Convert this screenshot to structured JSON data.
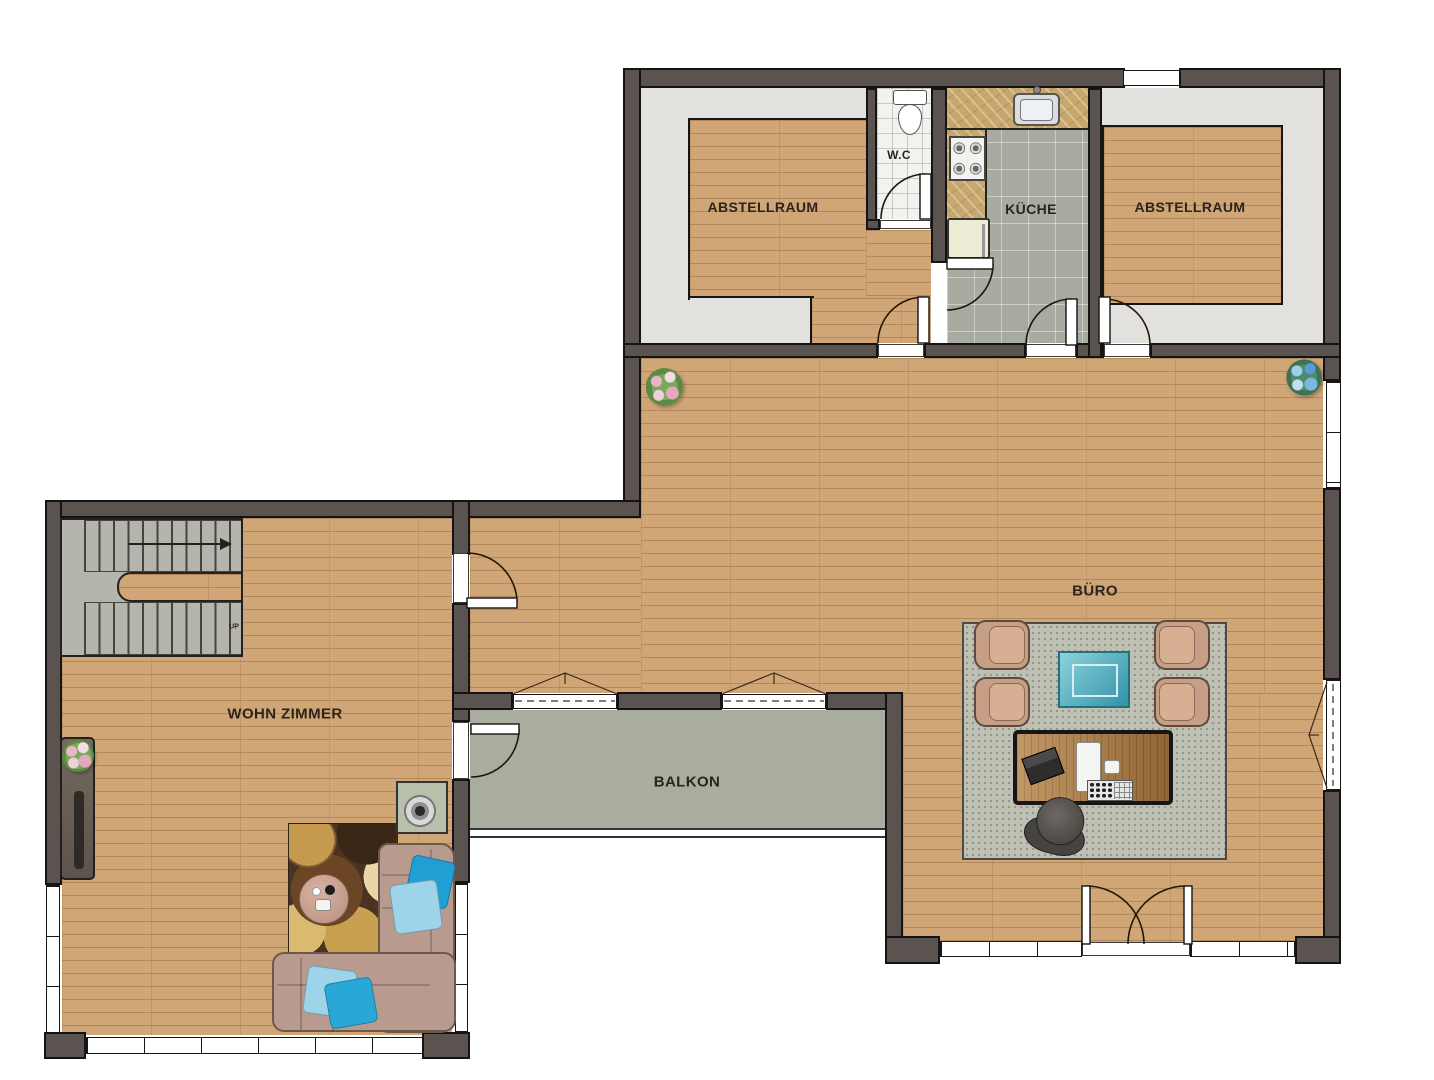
{
  "rooms": {
    "abstellraum_left": {
      "label": "ABSTELLRAUM"
    },
    "wc": {
      "label": "W.C"
    },
    "kueche": {
      "label": "KÜCHE"
    },
    "abstellraum_right": {
      "label": "ABSTELLRAUM"
    },
    "buero": {
      "label": "BÜRO"
    },
    "wohn_zimmer": {
      "label": "WOHN ZIMMER"
    },
    "balkon": {
      "label": "BALKON"
    }
  },
  "stairs": {
    "direction_label": "UP"
  },
  "colors": {
    "wall": "#5b5350",
    "wood_floor": "#d0a677",
    "gray_floor": "#e2e1dd",
    "kitchen_tile": "#a8aba0",
    "wc_tile": "#f2f2ef",
    "counter_marble": "#c7a76c",
    "balcony_floor": "#a9ad9f",
    "office_rug": "#bdc0b3",
    "coffee_table_teal": "#46aabc",
    "armchair": "#c79e86",
    "sofa": "#b89b8e",
    "pillow_dark_cyan": "#29a8d8",
    "pillow_light_cyan": "#9ed4ea",
    "desk_wood": "#ad7c44"
  }
}
